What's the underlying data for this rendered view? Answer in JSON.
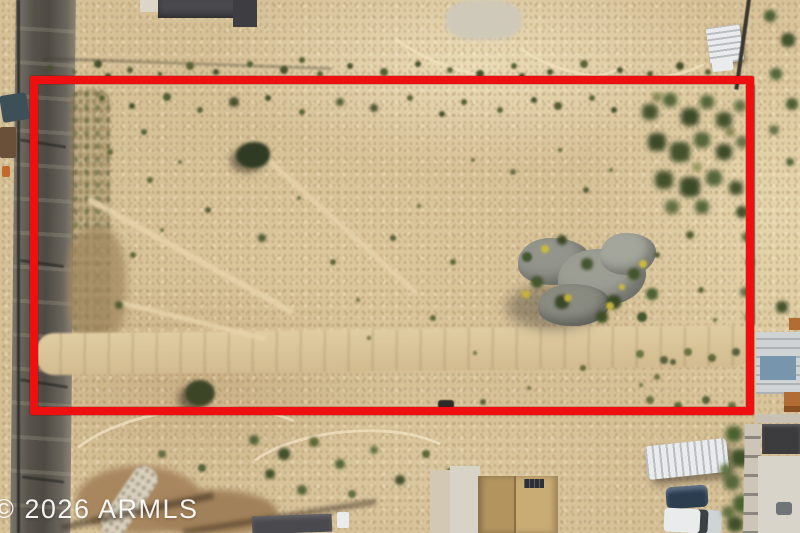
{
  "watermark": {
    "text": "© 2026 ARMLS"
  },
  "colors": {
    "boundary_red": "#ee1010",
    "ground_tan": "#d6c197",
    "sand_light": "#e8d9b4",
    "road_gray": "#55524b",
    "vegetation_green": "#55663a",
    "rock_gray": "#93958c",
    "brittlebush_yellow": "#c6b23a",
    "watermark_white": "#ffffff"
  }
}
